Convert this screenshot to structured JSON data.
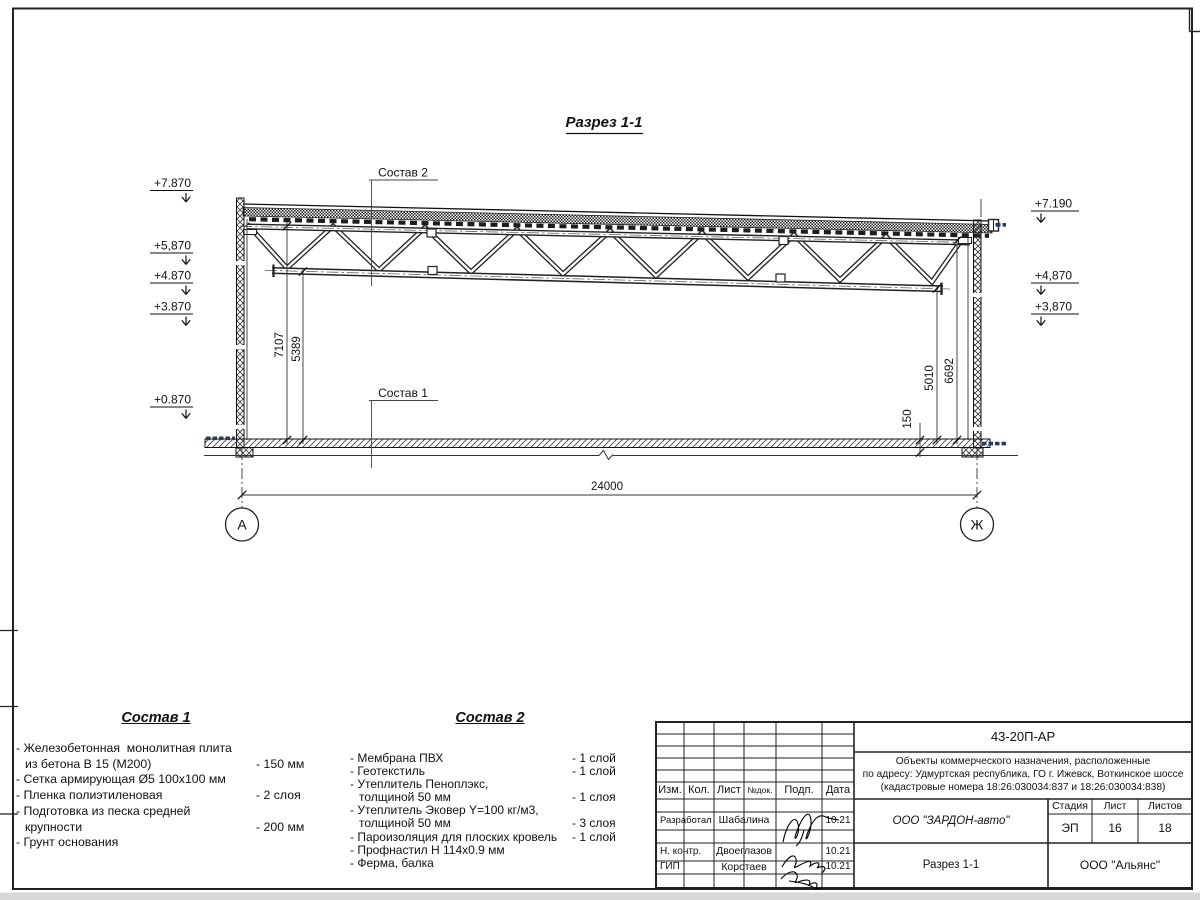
{
  "drawing": {
    "title": "Разрез 1-1",
    "leader_top_label": "Состав 2",
    "leader_bottom_label": "Состав 1",
    "dim_span": "24000",
    "dim_left_outer": "7107",
    "dim_left_inner": "5389",
    "dim_right_inner": "5010",
    "dim_right_outer": "6692",
    "dim_slab": "150",
    "axis_left": "А",
    "axis_right": "Ж",
    "elevations_left": [
      {
        "label": "+7.870"
      },
      {
        "label": "+5,870"
      },
      {
        "label": "+4.870"
      },
      {
        "label": "+3.870"
      },
      {
        "label": "+0.870"
      }
    ],
    "elevations_right": [
      {
        "label": "+7.190"
      },
      {
        "label": "+4,870"
      },
      {
        "label": "+3,870"
      }
    ]
  },
  "composition1": {
    "heading": "Состав 1",
    "lines": [
      {
        "text": "- Железобетонная  монолитная плита",
        "value": ""
      },
      {
        "text": "из бетона В 15 (М200)",
        "value": "- 150 мм",
        "indent": true
      },
      {
        "text": "- Сетка армирующая Ø5 100х100 мм",
        "value": ""
      },
      {
        "text": "- Пленка полиэтиленовая",
        "value": "-  2 слоя"
      },
      {
        "text": "- Подготовка из песка средней",
        "value": ""
      },
      {
        "text": "крупности",
        "value": "- 200 мм",
        "indent": true
      },
      {
        "text": "- Грунт основания",
        "value": ""
      }
    ]
  },
  "composition2": {
    "heading": "Состав 2",
    "lines": [
      {
        "text": "- Мембрана ПВХ",
        "value": "- 1 слой"
      },
      {
        "text": "- Геотекстиль",
        "value": "- 1 слой"
      },
      {
        "text": "- Утеплитель Пеноплэкс,",
        "value": ""
      },
      {
        "text": "толщиной 50 мм",
        "value": "- 1 слоя",
        "indent": true
      },
      {
        "text": "- Утеплитель Эковер Y=100 кг/м3,",
        "value": ""
      },
      {
        "text": "толщиной 50 мм",
        "value": "- 3 слоя",
        "indent": true
      },
      {
        "text": "- Пароизоляция для плоских кровель",
        "value": "- 1 слой"
      },
      {
        "text": "- Профнастил Н 114х0.9 мм",
        "value": ""
      },
      {
        "text": "- Ферма, балка",
        "value": ""
      }
    ]
  },
  "titleblock": {
    "doc_number": "43-20П-АР",
    "address_line1": "Объекты коммерческого назначения, расположенные",
    "address_line2": "по адресу: Удмуртская республика, ГО г. Ижевск, Воткинское шоссе",
    "address_line3": "(кадастровые номера 18:26:030034:837 и 18:26:030034:838)",
    "col_izm": "Изм.",
    "col_kol": "Кол.",
    "col_list": "Лист",
    "col_ndok": "№док.",
    "col_podp": "Подп.",
    "col_data": "Дата",
    "rows": [
      {
        "role": "Разработал",
        "name": "Шабалина",
        "date": "10.21"
      },
      {
        "role": "Н. контр.",
        "name": "Двоеглазов",
        "date": "10.21"
      },
      {
        "role": "ГИП",
        "name": "Коротаев",
        "date": "10.21"
      }
    ],
    "company": "ООО \"ЗАРДОН-авто\"",
    "stage_label": "Стадия",
    "sheet_label": "Лист",
    "sheets_label": "Листов",
    "stage": "ЭП",
    "sheet": "16",
    "sheets": "18",
    "section_name": "Разрез 1-1",
    "firm": "ООО \"Альянс\""
  }
}
